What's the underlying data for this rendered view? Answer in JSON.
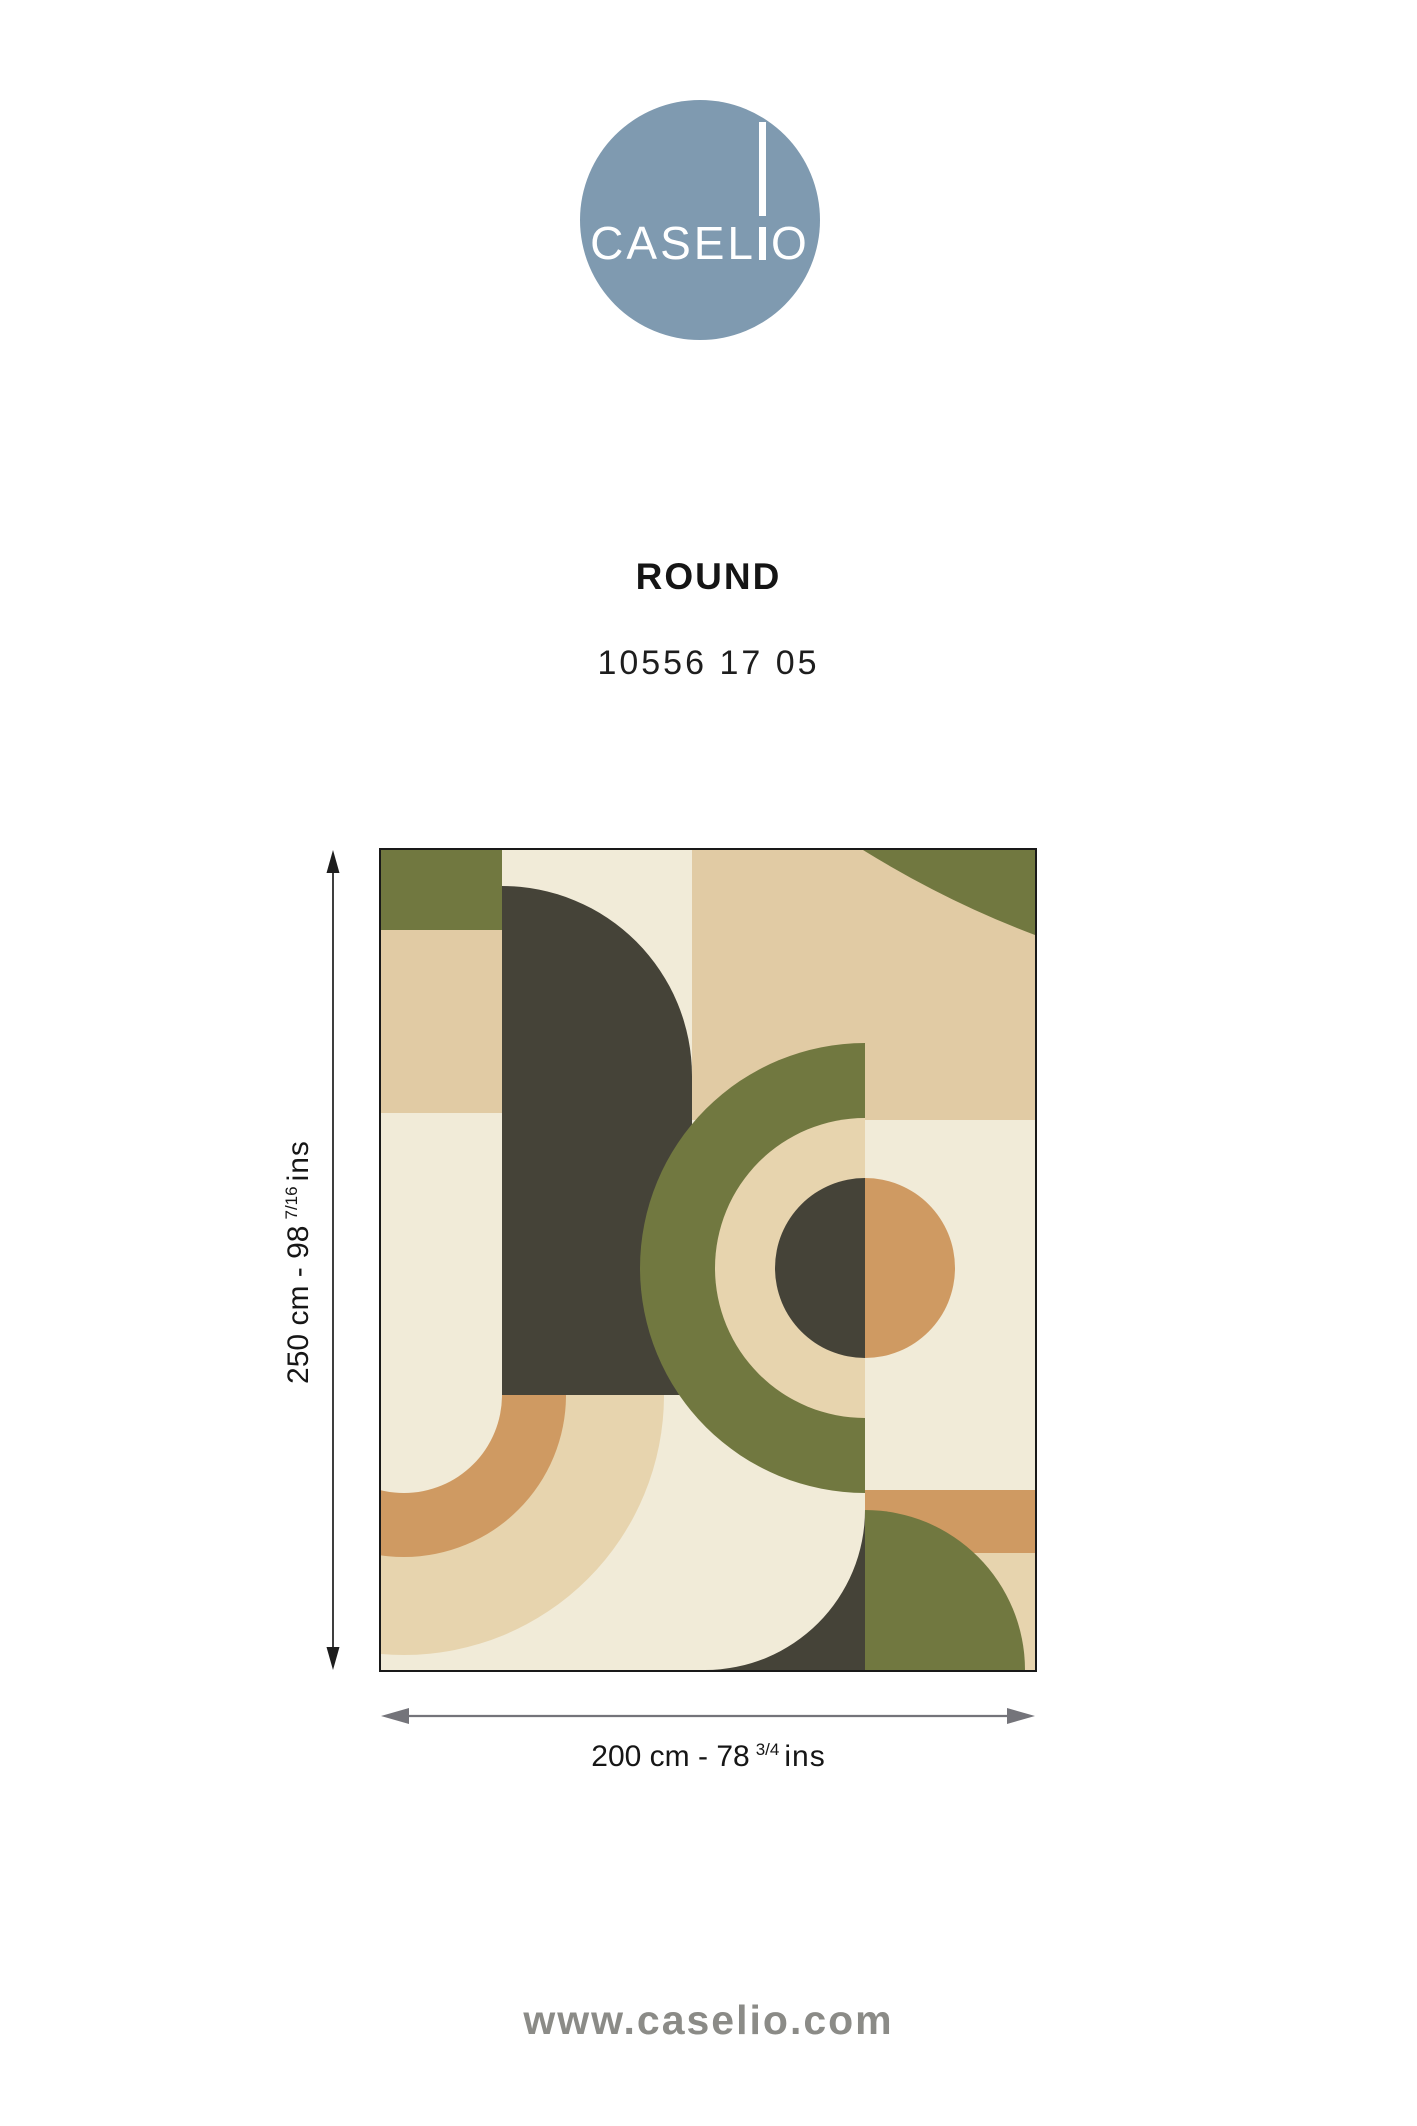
{
  "brand": {
    "logo_left": "CASEL",
    "logo_right": "O",
    "logo_full": "CASELIO"
  },
  "product": {
    "collection_name": "ROUND",
    "reference": "10556 17 05"
  },
  "dimensions": {
    "height": {
      "main": "250 cm - 98",
      "fraction": "7/16",
      "unit": "ins"
    },
    "width": {
      "main": "200 cm - 78",
      "fraction": "3/4",
      "unit": "ins"
    }
  },
  "footer": {
    "website": "www.caselio.com"
  },
  "colors": {
    "logo_blue": "#7f9ab0",
    "ink": "#1a1a1a",
    "arrow_gray": "#74747a",
    "footer_gray": "#8b8b87",
    "cream": "#f1ebd8",
    "tan": "#e1cba4",
    "beige": "#e7d4ae",
    "olive": "#717840",
    "charcoal": "#454338",
    "terracotta": "#cf9a62"
  }
}
